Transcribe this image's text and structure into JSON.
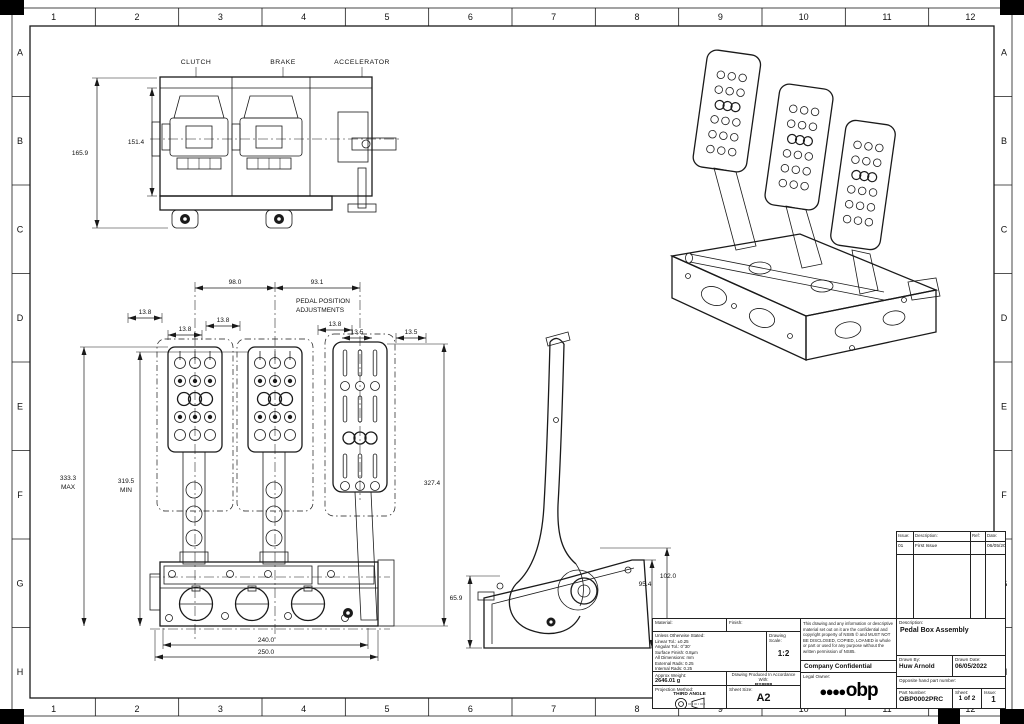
{
  "border": {
    "columns": [
      "1",
      "2",
      "3",
      "4",
      "5",
      "6",
      "7",
      "8",
      "9",
      "10",
      "11",
      "12"
    ],
    "rows": [
      "A",
      "B",
      "C",
      "D",
      "E",
      "F",
      "G",
      "H"
    ]
  },
  "views": {
    "top": {
      "label_clutch": "CLUTCH",
      "label_brake": "BRAKE",
      "label_accelerator": "ACCELERATOR",
      "dim_overall_height": "165.9",
      "dim_inner_height": "151.4"
    },
    "front": {
      "dim_pedal_spacing_left": "98.0",
      "dim_pedal_spacing_right": "93.1",
      "note_line1": "PEDAL POSITION",
      "note_line2": "ADJUSTMENTS",
      "dim_adjust_1": "13.8",
      "dim_adjust_2": "13.8",
      "dim_adjust_3": "13.8",
      "dim_adjust_4": "13.8",
      "dim_adjust_5": "13.5",
      "dim_adjust_6": "13.5",
      "dim_height_max": "333.3",
      "dim_height_max_suffix": "MAX",
      "dim_height_min": "319.5",
      "dim_height_min_suffix": "MIN",
      "dim_accel_height": "327.4",
      "dim_base_width_inner": "240.0",
      "dim_base_width_outer": "250.0"
    },
    "side": {
      "dim_bracket_height": "65.9",
      "dim_mid_height": "95.4",
      "dim_overall_height": "102.0"
    }
  },
  "revision_table": {
    "headers": {
      "issue": "Issue:",
      "description": "Description:",
      "ref": "Ref:",
      "date": "Date:"
    },
    "rows": [
      {
        "issue": "01",
        "description": "First Issue",
        "ref": "",
        "date": "06/05/2022"
      }
    ]
  },
  "title_block": {
    "material_label": "Material:",
    "finish_label": "Finish:",
    "tolerance_notes": {
      "line1": "Unless Otherwise Stated:",
      "line2": "Linear Tol.: ±0.25",
      "line3": "Angular Tol.: 0°30'",
      "line4": "Surface Finish: 0.8µm",
      "line5": "All Dimensions: mm",
      "line6": "External Rads: 0.25",
      "line7": "Internal Rads: 0.25",
      "line8": "BREAK SHARP EDGES"
    },
    "drawing_scale_label": "Drawing Scale:",
    "drawing_scale": "1:2",
    "approx_weight_label": "Approx Weight:",
    "approx_weight": "2646.01 g",
    "produced_label": "Drawing Produced In Accordance With:",
    "produced_standard": "BS8888",
    "projection_label": "Projection Method:",
    "projection": "THIRD ANGLE",
    "sheet_size_label": "Sheet Size:",
    "sheet_size": "A2",
    "confidentiality": "This drawing and any information or descriptive material set out on it are the confidential and copyright property of NS85 © and MUST NOT BE DISCLOSED, COPIED, LOANED in whole or part or used for any purpose without the written permission of NS85.",
    "confidential_line": "Company Confidential",
    "legal_owner_label": "Legal Owner:",
    "logo_dots": "●●●●",
    "logo_text": "obp",
    "description_label": "Description:",
    "description": "Pedal Box Assembly",
    "drawn_by_label": "Drawn By:",
    "drawn_by": "Huw Arnold",
    "drawn_date_label": "Drawn Date:",
    "drawn_date": "06/05/2022",
    "opposite_label": "Opposite hand part number:",
    "part_number_label": "Part Number:",
    "part_number": "OBP0002PRC",
    "sheet_label": "Sheet:",
    "sheet": "1 of 2",
    "issue_label": "Issue:",
    "issue": "1"
  }
}
